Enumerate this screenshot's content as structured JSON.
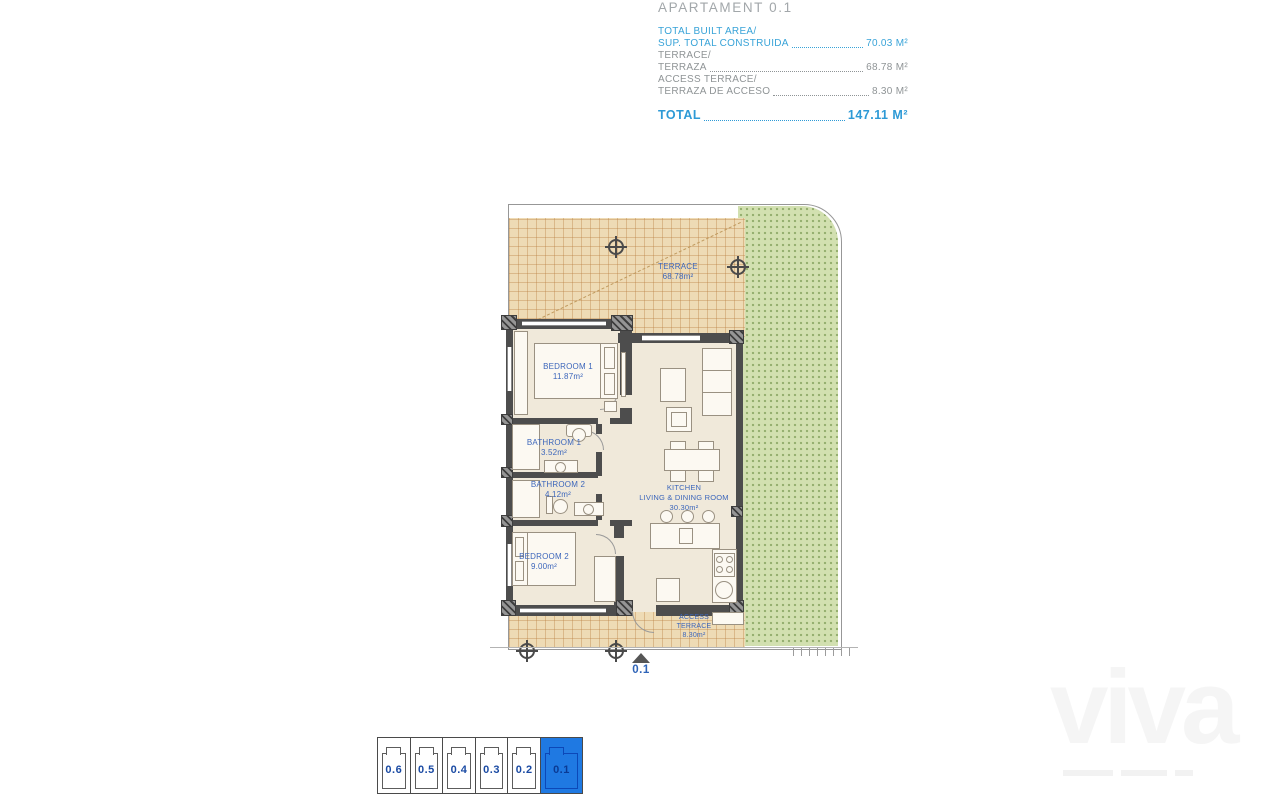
{
  "header": {
    "title": "APARTAMENT 0.1",
    "rows": [
      {
        "line1": "TOTAL BUILT AREA/",
        "line2": "SUP. TOTAL CONSTRUIDA",
        "value": "70.03 M²"
      },
      {
        "line1": "TERRACE/",
        "line2": "TERRAZA",
        "value": "68.78 M²"
      },
      {
        "line1": "ACCESS TERRACE/",
        "line2": "TERRAZA DE ACCESO",
        "value": "8.30 M²"
      }
    ],
    "total_label": "TOTAL",
    "total_value": "147.11 M²"
  },
  "plan": {
    "terrace": {
      "name": "TERRACE",
      "area": "68.78m²"
    },
    "bedroom1": {
      "name": "BEDROOM 1",
      "area": "11.87m²"
    },
    "bathroom1": {
      "name": "BATHROOM 1",
      "area": "3.52m²"
    },
    "bathroom2": {
      "name": "BATHROOM 2",
      "area": "4.12m²"
    },
    "bedroom2": {
      "name": "BEDROOM 2",
      "area": "9.00m²"
    },
    "kitchen": {
      "name": "KITCHEN",
      "name2": "LIVING & DINING ROOM",
      "area": "30.30m²"
    },
    "access": {
      "name": "ACCESS",
      "name2": "TERRACE",
      "area": "8.30m²"
    },
    "unit_marker": "0.1"
  },
  "selector": {
    "units": [
      {
        "label": "0.6",
        "active": false
      },
      {
        "label": "0.5",
        "active": false
      },
      {
        "label": "0.4",
        "active": false
      },
      {
        "label": "0.3",
        "active": false
      },
      {
        "label": "0.2",
        "active": false
      },
      {
        "label": "0.1",
        "active": true
      }
    ]
  },
  "watermark": "viva",
  "colors": {
    "accent_blue": "#38a3d8",
    "label_blue": "#3c66bb",
    "selector_blue": "#1f79e2"
  }
}
